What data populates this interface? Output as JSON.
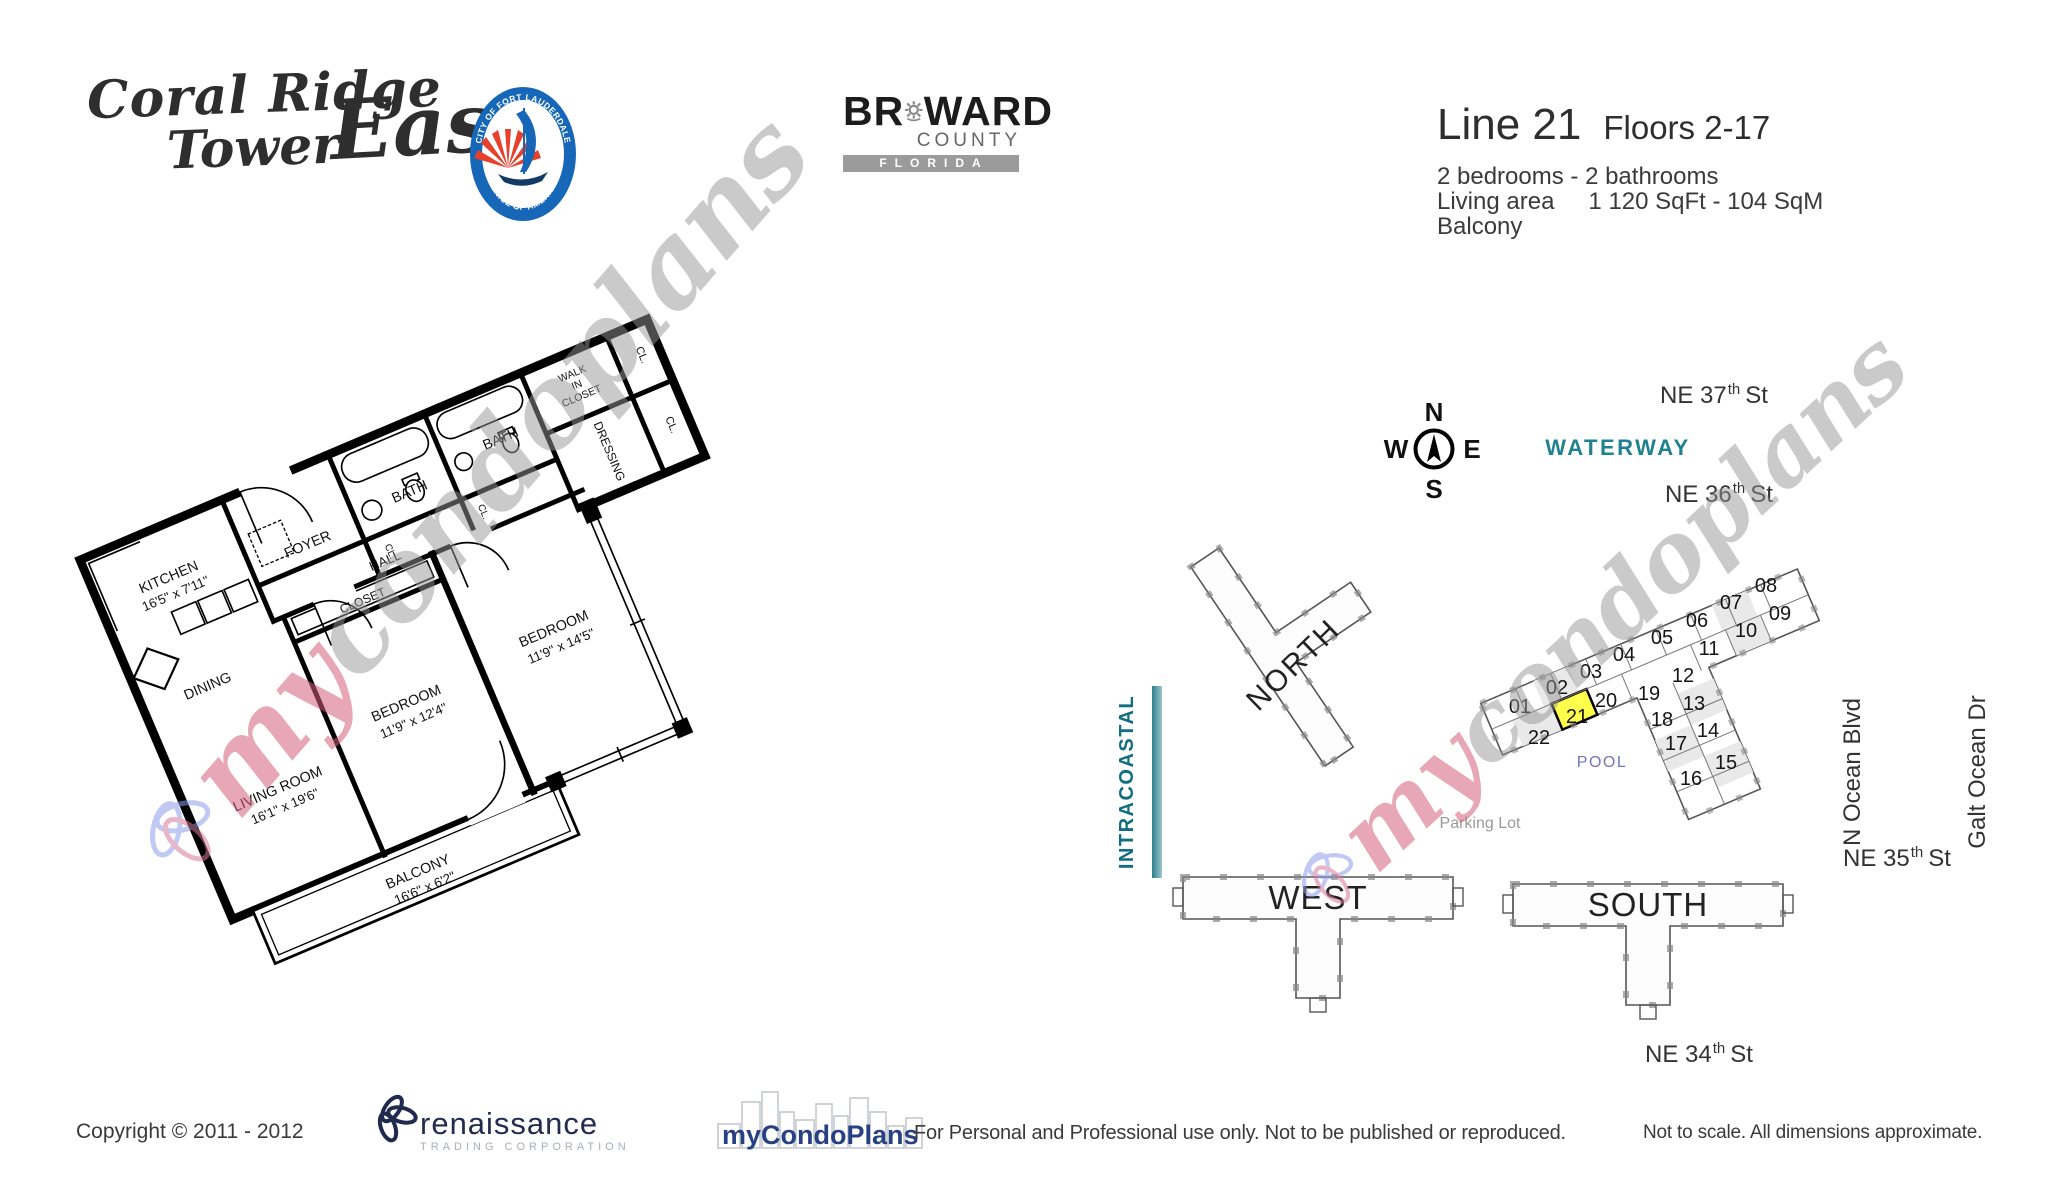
{
  "header": {
    "brand": {
      "line1": "Coral Ridge",
      "line2": "Tower",
      "east": "East"
    },
    "seal": {
      "top": "CITY OF FORT LAUDERDALE",
      "bottom": "VENICE OF AMERICA"
    },
    "broward": {
      "pre": "BR",
      "post": "WARD",
      "county": "COUNTY",
      "state": "FLORIDA"
    },
    "unit": {
      "line": "Line 21",
      "floors": "Floors 2-17",
      "rooms": "2 bedrooms - 2 bathrooms",
      "area_label": "Living area",
      "area_value": "1 120 SqFt - 104 SqM",
      "balcony": "Balcony"
    }
  },
  "floorplan": {
    "kitchen": {
      "label": "KITCHEN",
      "dims": "16'5\" x 7'11\""
    },
    "foyer": "FOYER",
    "bath": "BATH",
    "walkin": {
      "l1": "WALK",
      "l2": "IN",
      "l3": "CLOSET"
    },
    "dressing": "DRESSING",
    "cl": "CL.",
    "hall": "HALL",
    "closet": "CLOSET",
    "bedroom1": {
      "label": "BEDROOM",
      "dims": "11'9\" x 12'4\""
    },
    "bedroom2": {
      "label": "BEDROOM",
      "dims": "11'9\" x 14'5\""
    },
    "dining": "DINING",
    "living": {
      "label": "LIVING ROOM",
      "dims": "16'1\" x 19'6\""
    },
    "balcony": {
      "label": "BALCONY",
      "dims": "16'6\" x 6'2\""
    }
  },
  "sitemap": {
    "compass": {
      "n": "N",
      "e": "E",
      "s": "S",
      "w": "W"
    },
    "streets": {
      "ne37": {
        "pre": "NE 37",
        "sup": "th",
        "post": "St"
      },
      "ne36": {
        "pre": "NE 36",
        "sup": "th",
        "post": "St"
      },
      "ne35": {
        "pre": "NE 35",
        "sup": "th",
        "post": "St"
      },
      "ne34": {
        "pre": "NE 34",
        "sup": "th",
        "post": "St"
      },
      "n_ocean": "N Ocean Blvd",
      "galt": "Galt Ocean Dr"
    },
    "waterway": "WATERWAY",
    "intracoastal": "INTRACOASTAL",
    "pool": "POOL",
    "parking": "Parking Lot",
    "buildings": {
      "north": "NORTH",
      "west": "WEST",
      "south": "SOUTH"
    },
    "units": [
      "01",
      "02",
      "03",
      "04",
      "05",
      "06",
      "07",
      "08",
      "09",
      "10",
      "11",
      "12",
      "13",
      "14",
      "15",
      "16",
      "17",
      "18",
      "19",
      "20",
      "21",
      "22"
    ],
    "highlighted_unit": "21",
    "highlight_color": "#ffff4c",
    "teal": "#1a7f8e",
    "pool_color": "#7474b8"
  },
  "watermark": {
    "my": "my",
    "rest": "condoplans"
  },
  "footer": {
    "copyright": "Copyright © 2011 - 2012",
    "renaissance": "renaissance",
    "renaissance_sub": "TRADING CORPORATION",
    "mycondoplans": "myCondoPlans",
    "usage": "For Personal and Professional use only.  Not to be published or reproduced.",
    "note": "Not to scale.  All dimensions approximate."
  }
}
